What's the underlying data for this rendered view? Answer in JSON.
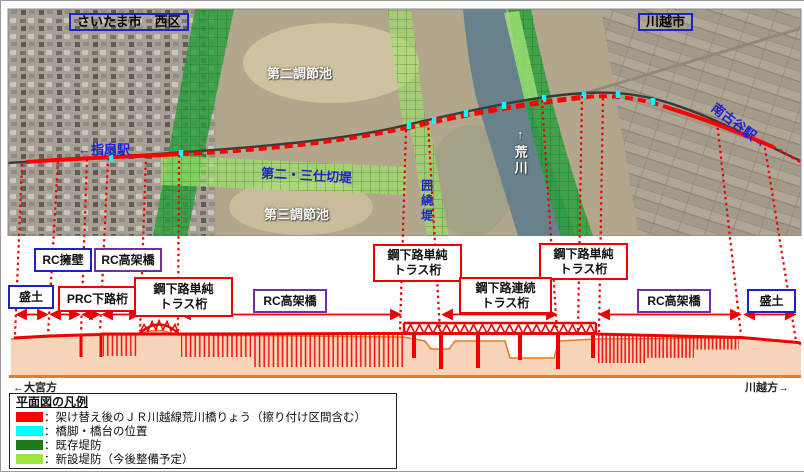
{
  "aerial": {
    "city_left": "さいたま市　西区",
    "city_right": "川越市",
    "pond2": "第二調節池",
    "pond3": "第三調節池",
    "partition_levee": "第二・三仕切堤",
    "station_left": "←指扇駅",
    "station_right": "南古谷駅→",
    "surrounding_levee": "囲繞堤",
    "river": "↑荒川"
  },
  "elevation": {
    "labels": {
      "rc_wall": "RC擁壁",
      "rc_viaduct_1": "RC高架橋",
      "steel_simple_truss_1": "鋼下路単純\nトラス桁",
      "steel_simple_truss_2": "鋼下路単純\nトラス桁",
      "steel_simple_truss_3": "鋼下路単純\nトラス桁",
      "embankment_left": "盛土",
      "prc_girder": "PRC下路桁",
      "rc_viaduct_2": "RC高架橋",
      "steel_continuous_truss": "鋼下路連続\nトラス桁",
      "rc_viaduct_3": "RC高架橋",
      "embankment_right": "盛土"
    },
    "direction_left": "←大宮方",
    "direction_right": "川越方→"
  },
  "legend": {
    "title": "平面図の凡例",
    "items": [
      {
        "color": "#ff0000",
        "label": "：架け替え後のＪＲ川越線荒川橋りょう（擦り付け区間含む）"
      },
      {
        "color": "#00ffff",
        "label": "：橋脚・橋台の位置"
      },
      {
        "color": "#1c7c1c",
        "label": "：既存堤防"
      },
      {
        "color": "#9ce53c",
        "label": "：新設堤防（今後整備予定）"
      }
    ]
  },
  "colors": {
    "alignment_red": "#ff0000",
    "pier_cyan": "#00ffff",
    "existing_levee_green": "#2aa13c",
    "new_levee_green": "#9fe468",
    "label_blue": "#1e22cc",
    "label_purple": "#7030a0",
    "ground_fill": "#f8d5b8",
    "ground_line_orange": "#e87a28"
  }
}
